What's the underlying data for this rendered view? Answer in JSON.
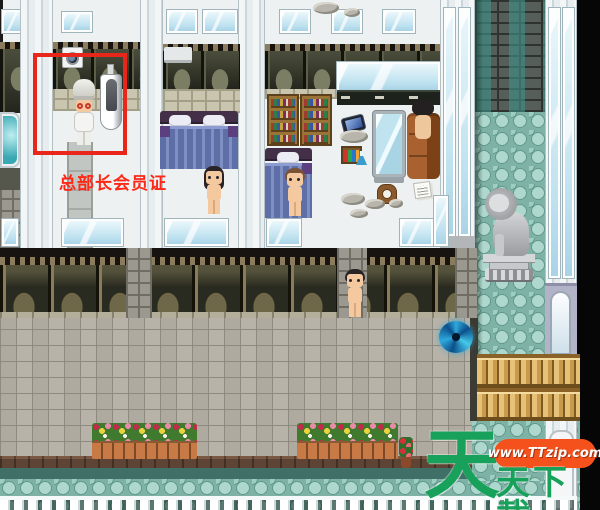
{
  "annotation": {
    "label": "总部长会员证"
  },
  "watermark": {
    "big_char": "天",
    "brand_suffix": "天下載",
    "url": "www.TTzip.com"
  },
  "colors": {
    "annotation_red": "#ff2817",
    "highlight_box_red": "#e8261a",
    "watermark_green": "#17a15a",
    "watermark_pill_orange": "#f4511c",
    "portal_blue": "#2ea8dc",
    "corridor_teal": "#7fb2a6",
    "street_cobble": "#b7b3a8"
  },
  "entities": {
    "npcs": [
      "chef",
      "long-black-hair-woman",
      "brown-hair-person",
      "street-walker",
      "couch-sitter"
    ],
    "objects": [
      "urinal",
      "washing-machine",
      "bathtub",
      "double-bed",
      "single-bed",
      "bookshelves",
      "wall-window",
      "standing-mirror",
      "leather-couch",
      "smartphone",
      "potion-rack",
      "flask",
      "mantel-clock",
      "paper-stack",
      "air-conditioner",
      "lion-statue",
      "blue-portal",
      "wooden-fence",
      "flower-beds",
      "white-railing",
      "arched-door"
    ]
  }
}
